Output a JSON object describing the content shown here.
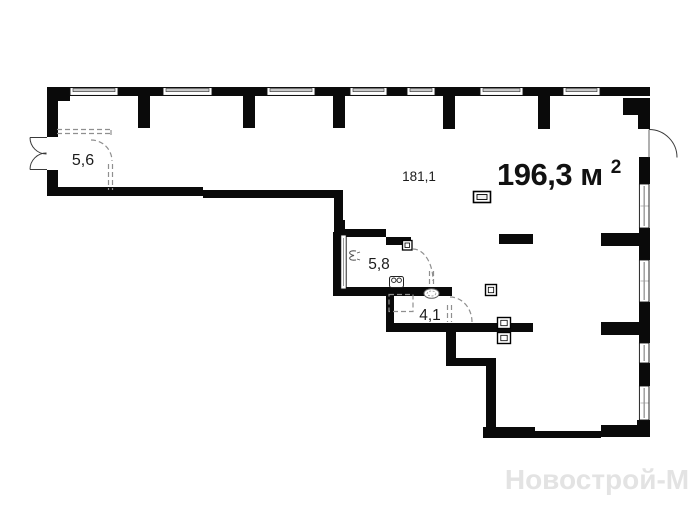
{
  "plan": {
    "labels": {
      "room_hall_area": "5,6",
      "room_main_area": "181,1",
      "room_bath_area": "5,8",
      "room_wc_area": "4,1",
      "total_area_value": "196,3 м",
      "total_area_sup": "2"
    },
    "watermark": "Новострой-М",
    "colors": {
      "wall": "#0a0a0a",
      "window_fill": "#ffffff",
      "window_frame": "#c9c9c9",
      "dashed": "#8f8f8f",
      "text": "#1c1c1c",
      "watermark": "#e3e3e3",
      "background": "#ffffff"
    },
    "icons": [
      {
        "name": "entrance-double-door-swing-icon"
      },
      {
        "name": "terrace-door-swing-icon"
      },
      {
        "name": "dashed-door-swing-icon"
      },
      {
        "name": "sliding-door-icon"
      },
      {
        "name": "electrical-panel-icon"
      },
      {
        "name": "socket-icon"
      },
      {
        "name": "sink-icon"
      },
      {
        "name": "basin-icon"
      },
      {
        "name": "vent-icon"
      },
      {
        "name": "window-icon"
      }
    ]
  }
}
